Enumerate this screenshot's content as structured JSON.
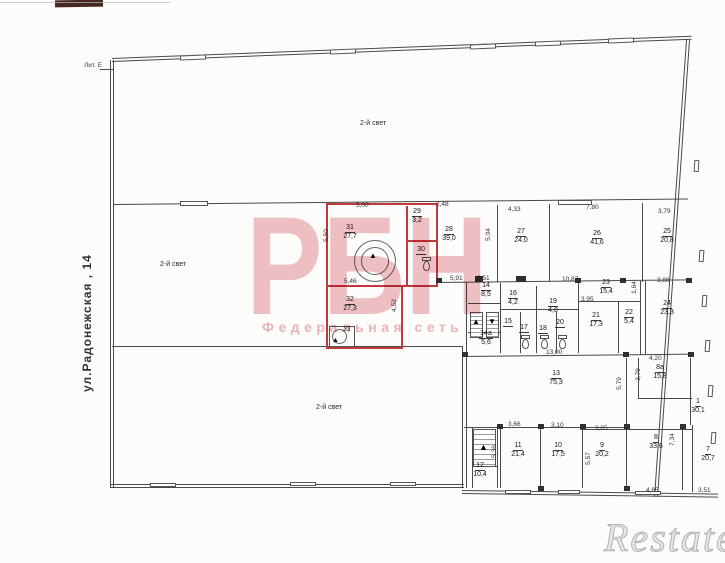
{
  "page": {
    "street_label": "ул.Радонежская , 14",
    "liter_label": "Лит. Е",
    "colors": {
      "highlight": "#c0393d",
      "watermark_pink": "#e2858d",
      "wall": "#4a4a4a"
    }
  },
  "watermark": {
    "brand": "РБН",
    "subtitle": "Федеральная сеть",
    "corner_brand": "Restate"
  },
  "icons": {
    "up_arrow": "▲",
    "down_arrow": "▼"
  },
  "halls": [
    {
      "label": "2-й свет"
    },
    {
      "label": "2-й свет"
    },
    {
      "label": "2-й свет"
    }
  ],
  "rooms": [
    {
      "number": "31",
      "area": "27,7"
    },
    {
      "number": "29",
      "area": "3,2"
    },
    {
      "number": "30",
      "area": ""
    },
    {
      "number": "32",
      "area": "27,3"
    },
    {
      "number": "33",
      "area": ""
    },
    {
      "number": "28",
      "area": "39,0"
    },
    {
      "number": "27",
      "area": "24,0"
    },
    {
      "number": "26",
      "area": "41,6"
    },
    {
      "number": "25",
      "area": "20,8"
    },
    {
      "number": "14",
      "area": "8,5"
    },
    {
      "number": "14а",
      "area": "5,6"
    },
    {
      "number": "16",
      "area": "4,2"
    },
    {
      "number": "15",
      "area": ""
    },
    {
      "number": "17",
      "area": ""
    },
    {
      "number": "18",
      "area": ""
    },
    {
      "number": "19",
      "area": "4,8"
    },
    {
      "number": "20",
      "area": ""
    },
    {
      "number": "23",
      "area": "15,4"
    },
    {
      "number": "21",
      "area": "17,3"
    },
    {
      "number": "22",
      "area": "5,4"
    },
    {
      "number": "24",
      "area": "23,3"
    },
    {
      "number": "13",
      "area": "75,3"
    },
    {
      "number": "8а",
      "area": "15,8"
    },
    {
      "number": "1",
      "area": "30,1"
    },
    {
      "number": "11",
      "area": "21,4"
    },
    {
      "number": "10",
      "area": "17,5"
    },
    {
      "number": "12",
      "area": "10,4"
    },
    {
      "number": "9",
      "area": "20,2"
    },
    {
      "number": "8",
      "area": "33,6"
    },
    {
      "number": "7",
      "area": "20,7"
    }
  ],
  "dims": [
    {
      "text": "5,00"
    },
    {
      "text": "2,48"
    },
    {
      "text": "5,50"
    },
    {
      "text": "5,46"
    },
    {
      "text": "4,52"
    },
    {
      "text": "4,33"
    },
    {
      "text": "7,80"
    },
    {
      "text": "3,79"
    },
    {
      "text": "5,04"
    },
    {
      "text": "5,91"
    },
    {
      "text": "2,51"
    },
    {
      "text": "10,87"
    },
    {
      "text": "3,88"
    },
    {
      "text": "3,95"
    },
    {
      "text": "1,64"
    },
    {
      "text": "13,00"
    },
    {
      "text": "4,20"
    },
    {
      "text": "5,79"
    },
    {
      "text": "3,79"
    },
    {
      "text": "3,66"
    },
    {
      "text": "3,10"
    },
    {
      "text": "3,65"
    },
    {
      "text": "5,36"
    },
    {
      "text": "5,57"
    },
    {
      "text": "7,34"
    },
    {
      "text": "4,65"
    },
    {
      "text": "3,51"
    }
  ]
}
